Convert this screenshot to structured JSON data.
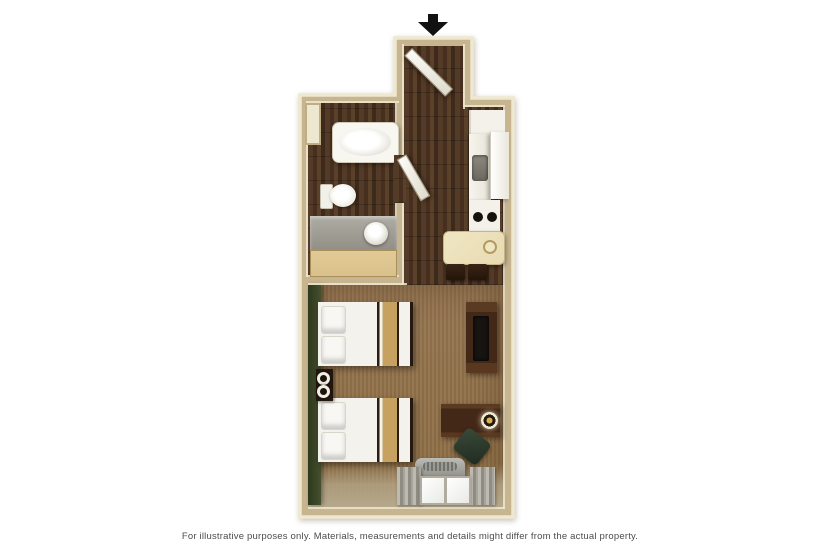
{
  "caption": "For illustrative purposes only.  Materials, measurements and details might differ from the actual property.",
  "icons": {
    "entrance_arrow": "black-down-arrow"
  },
  "palette": {
    "wall_fill": "#c7b58f",
    "wall_edge": "#efe8d1",
    "floor_wood_dark": "#4c3525",
    "carpet_brown": "#8e7048",
    "carpet_light": "#b2a283",
    "accent_wall_green": "#44502e",
    "linen_white": "#f3f2ed",
    "bed_runner_tan": "#c6a160",
    "furniture_dark_brown": "#452a18",
    "tv_black": "#181411",
    "appliance_white": "#f3f1ea",
    "burner_black": "#16120e",
    "table_cream": "#e7dbb2",
    "counter_gray": "#a19f97",
    "vanity_wood": "#d9c08b",
    "curtain_gray": "#a3a19a",
    "hvac_gray": "#a7a8a2",
    "chair_green": "#31402f",
    "door_white": "#f4f2ea",
    "arrow_black": "#111111",
    "caption_gray": "#4c4c4c"
  }
}
